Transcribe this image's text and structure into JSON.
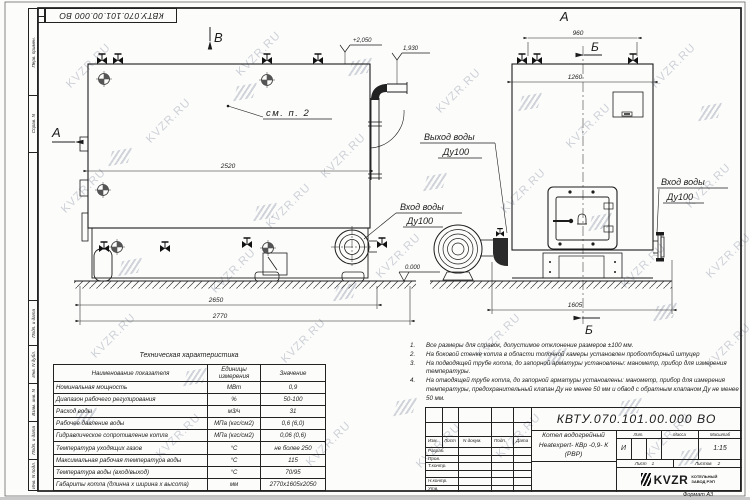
{
  "watermark": {
    "text": "KVZR.RU"
  },
  "frame": {
    "stamp_top": "КВТУ.070.101.00.000  ВО",
    "side_labels": [
      "Перв. примен.",
      "Справ. N",
      "Подп. и дата",
      "Инв. N дубл.",
      "Взам. инв. N",
      "Подп. и дата",
      "Инв. N подл."
    ],
    "format_label": "Формат",
    "format_value": "А3"
  },
  "drawing": {
    "view_labels": {
      "a_left": "А",
      "a_top": "А",
      "b_top": "Б",
      "b_bottom": "Б",
      "v_top": "В"
    },
    "callouts": {
      "see_note": "см. п. 2",
      "outlet_line1": "Выход воды",
      "outlet_line2": "Ду100",
      "inlet_mid_line1": "Вход воды",
      "inlet_mid_line2": "Ду100",
      "inlet_right_line1": "Вход воды",
      "inlet_right_line2": "Ду100"
    },
    "elevations": {
      "top": "+2,050",
      "pipe": "1,930",
      "zero": "0.000"
    },
    "dimensions": {
      "body_length": "2520",
      "base_length": "2650",
      "total_length": "2770",
      "lug_span": "960",
      "width_top": "1260",
      "base_width": "1605"
    }
  },
  "spec_table": {
    "title": "Техническая характеристика",
    "headers": [
      "Наименование показателя",
      "Единицы измерения",
      "Значение"
    ],
    "rows": [
      [
        "Номинальная мощность",
        "МВт",
        "0,9"
      ],
      [
        "Диапазон рабочего регулирования",
        "%",
        "50-100"
      ],
      [
        "Расход воды",
        "м3/ч",
        "31"
      ],
      [
        "Рабочее давление воды",
        "МПа (кгс/см2)",
        "0,6 (6,0)"
      ],
      [
        "Гидравлическое сопротивление котла",
        "МПа (кгс/см2)",
        "0,06 (0,6)"
      ],
      [
        "Температура уходящих газов",
        "°С",
        "не более 250"
      ],
      [
        "Максимальная рабочая температура воды",
        "°С",
        "115"
      ],
      [
        "Температура воды (вход/выход)",
        "°С",
        "70/95"
      ],
      [
        "Габариты котла (длинна х ширина х высота)",
        "мм",
        "2770х1605х2050"
      ]
    ]
  },
  "notes": {
    "items": [
      {
        "num": "1.",
        "text": "Все размеры для справок, допустимое отклонение размеров ±100 мм."
      },
      {
        "num": "2.",
        "text": "На боковой стенке котла в области топочной камеры установлен пробоотборный штуцер"
      },
      {
        "num": "3.",
        "text": "На  подводящей трубе котла, до запорной арматуры установлены: манометр, прибор для измерения температуры."
      },
      {
        "num": "4.",
        "text": "На отводящей трубе котла, до запорной арматуры установлены: манометр, прибор для измерения температуры, предохранительный клапан Ду не менее 50 мм и обвод с обратным клапаном Ду не менее 50 мм."
      }
    ]
  },
  "title_block": {
    "doc_number": "КВТУ.070.101.00.000  ВО",
    "rev_header": [
      "Изм.",
      "Лист",
      "N докум.",
      "Подп.",
      "Дата"
    ],
    "roles": [
      "Разраб.",
      "Пров.",
      "Т.контр.",
      "Н.контр.",
      "Утв."
    ],
    "product_line1": "Котел водогрейный",
    "product_line2": "Heatexpert- КВр -0,9- К (РВР)",
    "lit_header": "Лит.",
    "mass_header": "Масса",
    "scale_header": "Масштаб",
    "lit_value": "И",
    "scale_value": "1:15",
    "sheet_label": "Лист",
    "sheet_value": "1",
    "sheets_label": "Листов",
    "sheets_value": "2",
    "company_logo": "KVZR",
    "company_line1": "КОТЕЛЬНЫЙ",
    "company_line2": "ЗАВОД РЭП"
  }
}
